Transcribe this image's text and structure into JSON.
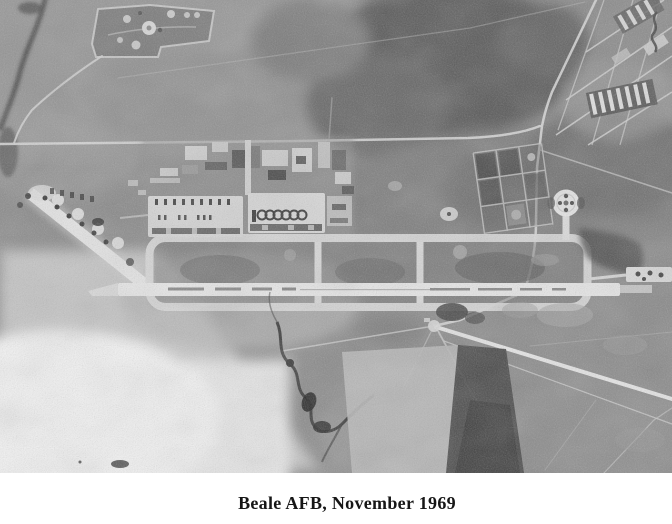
{
  "page": {
    "background": "#ffffff"
  },
  "figure": {
    "type": "halftone-aerial-photograph",
    "subject": "air-force-base-runway-complex",
    "caption": "Beale AFB, November 1969",
    "tones": {
      "terrain_mid": "#898989",
      "terrain_dark": "#565656",
      "runway_light": "#e9e9e9",
      "shadow_dark": "#3a3a3a",
      "caption_text": "#161616"
    }
  }
}
